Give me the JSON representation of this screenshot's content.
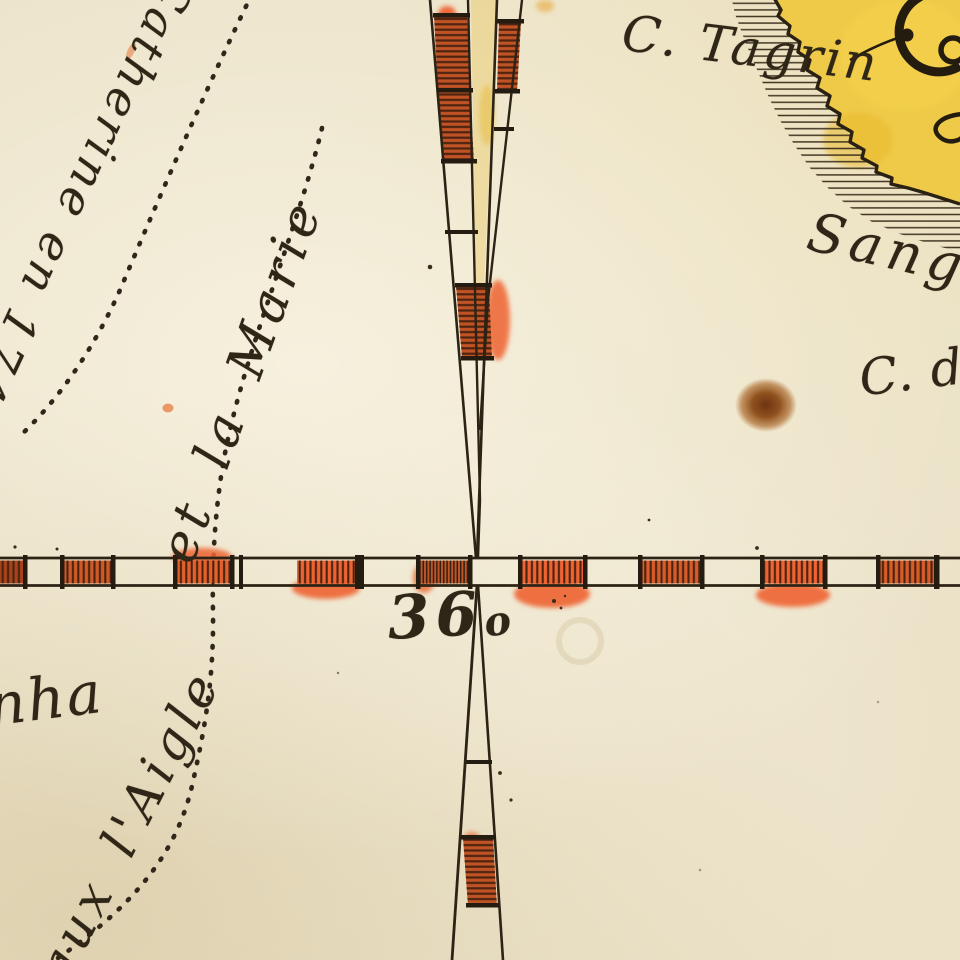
{
  "map": {
    "labels": {
      "cape_tagrin": "C. Tagrin",
      "sang_fragment": "Sang",
      "cape_des_fragment": "C. des",
      "route_catherine": "Catherine en 1740",
      "route_marie": "et la Marie",
      "route_aigle": "aux l'Aigle",
      "nha_fragment": "nha",
      "meridian_value": "36",
      "meridian_value_suffix": "o"
    },
    "colors": {
      "parchment": "#ebe2c8",
      "ink": "#2c2315",
      "band_red": "#cf5a28",
      "band_orange": "#ee6331",
      "land_yellow": "#efc83f",
      "stain_brown": "#8a4a1e"
    }
  }
}
